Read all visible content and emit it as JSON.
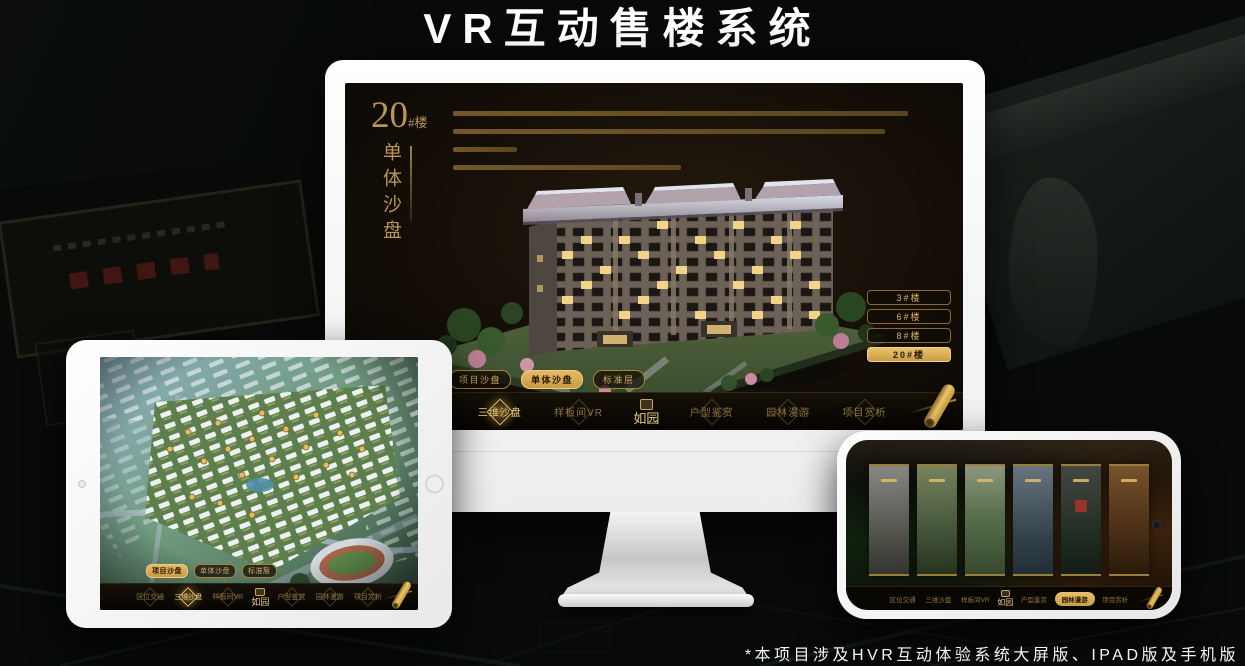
{
  "page": {
    "title": "VR互动售楼系统",
    "footnote": "*本项目涉及HVR互动体验系统大屏版、IPAD版及手机版"
  },
  "colors": {
    "gold": "#C9A24F",
    "gold_bright": "#E8C46E",
    "screen_background": "#140E07",
    "navbar_background": "#0B0804"
  },
  "nav": {
    "logo": "如园",
    "items": [
      "区位交通",
      "三维沙盘",
      "样板间VR",
      "户型鉴赏",
      "园林漫游",
      "项目赏析"
    ]
  },
  "sub_tabs": [
    "项目沙盘",
    "单体沙盘",
    "标准层"
  ],
  "monitor": {
    "headline": {
      "number": "20",
      "suffix": "#楼",
      "subtitle": "单体沙盘"
    },
    "floor_buttons": [
      {
        "label": "3#楼",
        "active": false
      },
      {
        "label": "6#楼",
        "active": false
      },
      {
        "label": "8#楼",
        "active": false
      },
      {
        "label": "20#楼",
        "active": true
      }
    ],
    "active_sub_tab": "单体沙盘",
    "active_nav": "三维沙盘"
  },
  "tablet": {
    "active_sub_tab": "项目沙盘",
    "active_nav": "三维沙盘"
  },
  "phone": {
    "active_nav": "园林漫游",
    "gallery_card_count": 6
  }
}
